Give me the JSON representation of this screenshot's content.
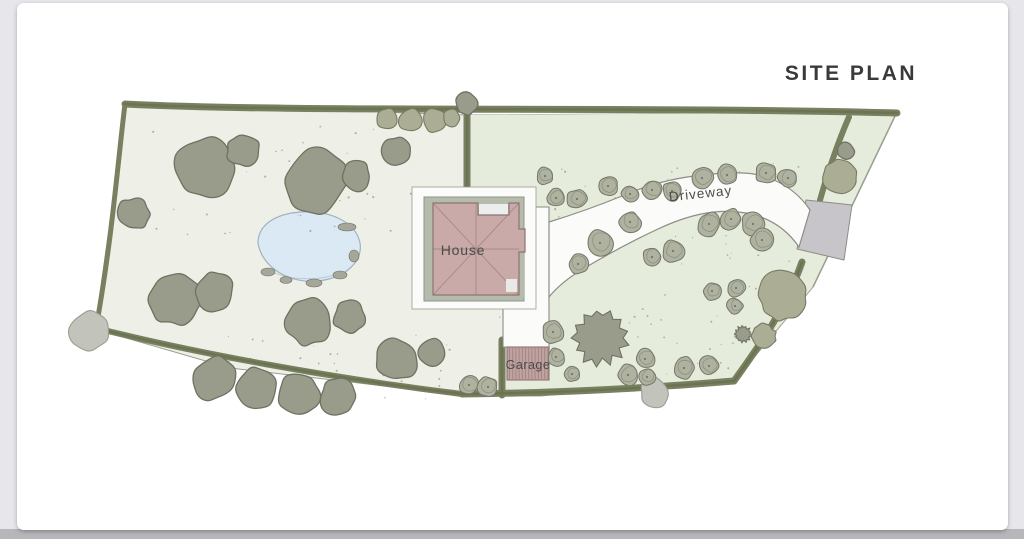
{
  "title": "SITE PLAN",
  "plan_labels": {
    "house": "House",
    "garage": "Garage",
    "driveway": "Driveway"
  },
  "colors": {
    "page_bg": "#e7e6ea",
    "page_bg_bottom": "#b7b6bb",
    "card_bg": "#ffffff",
    "lawn_left": "#eef0e8",
    "lawn_right": "#e6ecdc",
    "boundary": "#9a9d8f",
    "hedge": "#78805f",
    "hedge_core": "#68704f",
    "tree_dark": "#999c8a",
    "tree_dark_stroke": "#6e7260",
    "tree_gray": "#c2c3bb",
    "tree_gray_stroke": "#9b9d92",
    "scallop": "#abae95",
    "scallop_stroke": "#767b62",
    "shrub": "#aeb29e",
    "shrub_stroke": "#73776a",
    "pond": "#dbe9f4",
    "pond_stroke": "#9fb3c0",
    "rock": "#a5a79a",
    "pad": "#b6bcac",
    "pad_stroke": "#8f958a",
    "white_area": "#fbfbf9",
    "drive_stroke": "#8d8d85",
    "apron": "#c7c5c9",
    "roof": "#c9aaa8",
    "roof_stroke": "#8c7472",
    "garage": "#c2a2a1",
    "garage_stripe": "#9e8483",
    "label": "#4b4b48",
    "title": "#3a3a3d"
  }
}
